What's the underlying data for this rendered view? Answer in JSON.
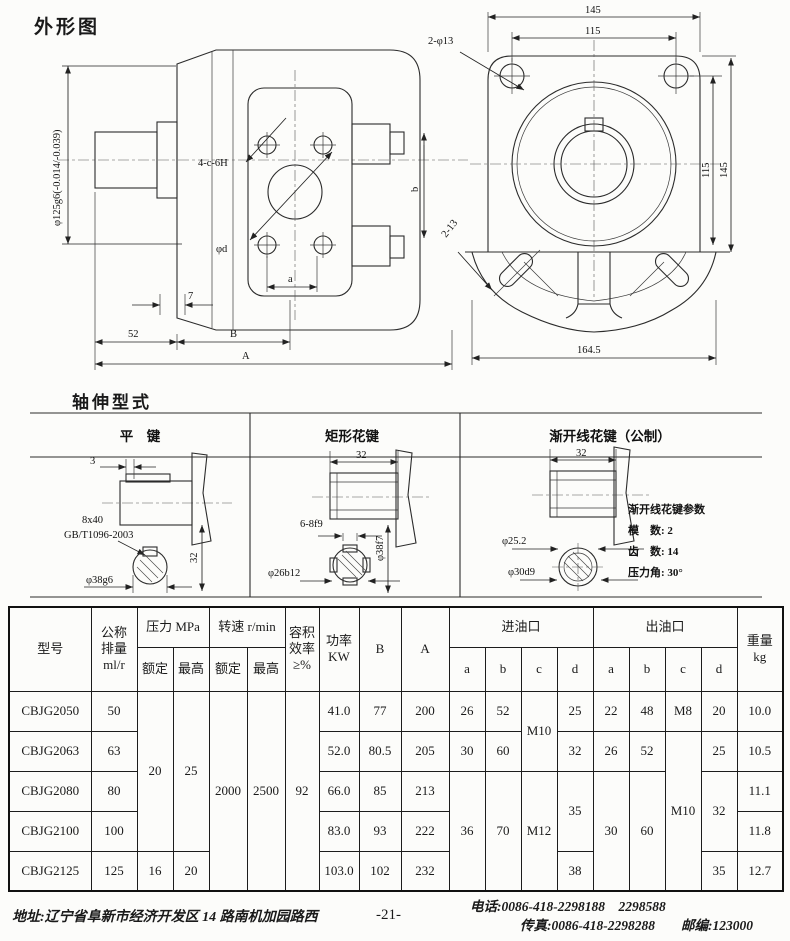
{
  "outline": {
    "title": "外形图",
    "left": {
      "dia_spigot": "φ125g6(-0.014/-0.039)",
      "bolts": "4-c-6H",
      "port_dia": "φd",
      "dim_a": "a",
      "dim_7": "7",
      "dim_b": "b",
      "dim_52": "52",
      "dim_B": "B",
      "dim_A": "A"
    },
    "right": {
      "dim_145_top": "145",
      "dim_115_top": "115",
      "holes": "2-φ13",
      "dim_115_side": "115",
      "dim_145_side": "145",
      "slots": "2-13",
      "dim_164_5": "164.5"
    }
  },
  "shaft_types": {
    "title": "轴伸型式",
    "flat_key": {
      "header": "平　键",
      "dim_3": "3",
      "key_size": "8x40",
      "key_std": "GB/T1096-2003",
      "dia": "φ38g6",
      "dim_32": "32"
    },
    "rect_spline": {
      "header": "矩形花键",
      "dim_32": "32",
      "spec": "6-8f9",
      "dia_minor": "φ26b12",
      "dia_major": "φ38f7"
    },
    "involute_spline": {
      "header": "渐开线花键（公制）",
      "dim_32": "32",
      "dia_minor": "φ25.2",
      "dia_major": "φ30d9",
      "params_title": "渐开线花键参数",
      "module": "模　数: 2",
      "teeth": "齿　数: 14",
      "pressure_angle": "压力角: 30°"
    }
  },
  "spec_table": {
    "headers": {
      "model": "型号",
      "displacement": "公称\n排量\nml/r",
      "pressure": "压力 MPa",
      "speed": "转速 r/min",
      "efficiency": "容积\n效率\n≥%",
      "power": "功率\nKW",
      "B": "B",
      "A": "A",
      "inlet": "进油口",
      "outlet": "出油口",
      "weight": "重量\nkg",
      "rated": "额定",
      "max": "最高",
      "a": "a",
      "b": "b",
      "c": "c",
      "d": "d"
    },
    "rows": [
      {
        "model": "CBJG2050",
        "disp": "50",
        "p_rated": "20",
        "p_max": "25",
        "n_rated": "2000",
        "n_max": "2500",
        "eff": "92",
        "kw": "41.0",
        "B": "77",
        "A": "200",
        "in_a": "26",
        "in_b": "52",
        "in_c": "M10",
        "in_d": "25",
        "out_a": "22",
        "out_b": "48",
        "out_c": "M8",
        "out_d": "20",
        "wt": "10.0"
      },
      {
        "model": "CBJG2063",
        "disp": "63",
        "kw": "52.0",
        "B": "80.5",
        "A": "205",
        "in_a": "30",
        "in_b": "60",
        "in_d": "32",
        "out_a": "26",
        "out_b": "52",
        "out_c": "M10",
        "out_d": "25",
        "wt": "10.5"
      },
      {
        "model": "CBJG2080",
        "disp": "80",
        "kw": "66.0",
        "B": "85",
        "A": "213",
        "in_a": "36",
        "in_b": "70",
        "in_c": "M12",
        "in_d": "35",
        "out_a": "30",
        "out_b": "60",
        "out_d": "32",
        "wt": "11.1"
      },
      {
        "model": "CBJG2100",
        "disp": "100",
        "kw": "83.0",
        "B": "93",
        "A": "222",
        "wt": "11.8"
      },
      {
        "model": "CBJG2125",
        "disp": "125",
        "p_rated": "16",
        "p_max": "20",
        "kw": "103.0",
        "B": "102",
        "A": "232",
        "in_d": "38",
        "out_d": "35",
        "wt": "12.7"
      }
    ]
  },
  "footer": {
    "address": "地址:辽宁省阜新市经济开发区 14 路南机加园路西",
    "page_no": "-21-",
    "phone": "电话:0086-418-2298188　2298588",
    "fax": "传真:0086-418-2298288",
    "postcode": "邮编:123000"
  }
}
